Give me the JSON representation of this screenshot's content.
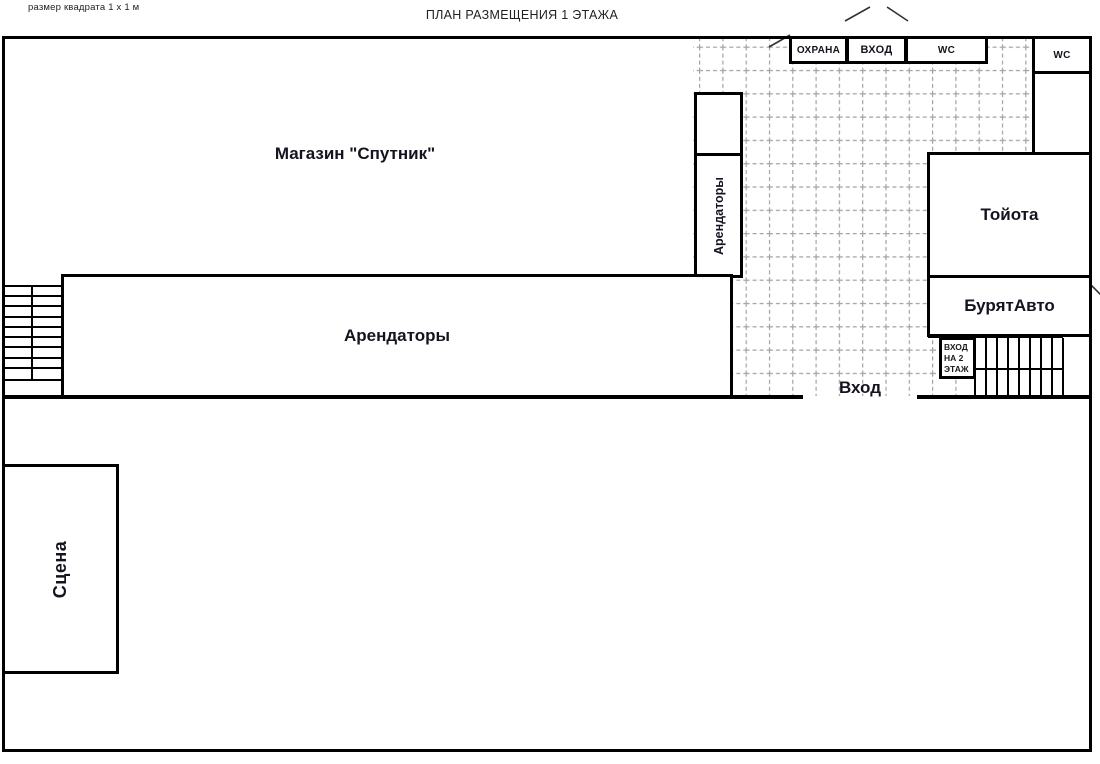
{
  "annotations": {
    "scale_note": "размер квадрата 1 х 1 м",
    "title": "ПЛАН РАЗМЕЩЕНИЯ 1 ЭТАЖА",
    "entrance_label": "Вход"
  },
  "rooms": {
    "shop": "Магазин \"Спутник\"",
    "tenants_big": "Арендаторы",
    "tenants_vertical": "Арендаторы",
    "toyota": "Тойота",
    "buryatavto": "БурятАвто",
    "stage": "Сцена",
    "security": "ОХРАНА",
    "entrance_top": "ВХОД",
    "wc_top": "WC",
    "wc_right": "WC",
    "entrance_floor2_line1": "ВХОД",
    "entrance_floor2_line2": "НА 2",
    "entrance_floor2_line3": "ЭТАЖ"
  },
  "colors": {
    "wall": "#000000",
    "grid": "#a3a3a3",
    "text": "#141420"
  }
}
